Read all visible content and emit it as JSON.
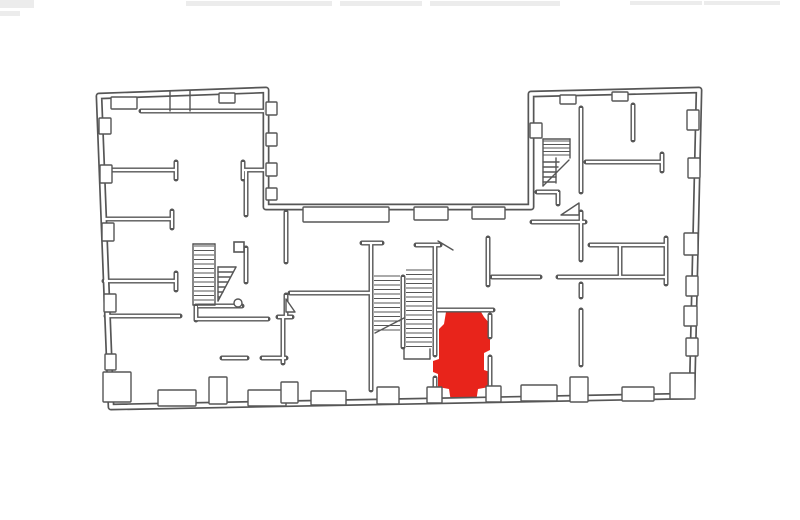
{
  "page": {
    "width": 800,
    "height": 520,
    "background": "#ffffff"
  },
  "plan": {
    "wall_color": "#565656",
    "paper_color": "#ffffff",
    "highlight_color": "#e8241b",
    "smudge_color": "#ececec",
    "top_smudges": [
      [
        0,
        0,
        34,
        8
      ],
      [
        186,
        1,
        146,
        5
      ],
      [
        340,
        1,
        82,
        5
      ],
      [
        430,
        1,
        130,
        5
      ],
      [
        630,
        1,
        72,
        4
      ],
      [
        704,
        1,
        76,
        4
      ],
      [
        0,
        11,
        20,
        5
      ]
    ],
    "outline": [
      [
        99,
        96
      ],
      [
        266,
        90
      ],
      [
        266,
        207
      ],
      [
        531,
        207
      ],
      [
        531,
        94
      ],
      [
        699,
        90
      ],
      [
        692,
        396
      ],
      [
        111,
        407
      ]
    ],
    "inner_walls": [
      [
        141,
        111,
        264,
        111
      ],
      [
        102,
        170,
        176,
        170
      ],
      [
        176,
        162,
        176,
        179
      ],
      [
        243,
        170,
        265,
        170
      ],
      [
        243,
        162,
        243,
        179
      ],
      [
        103,
        219,
        172,
        219
      ],
      [
        172,
        211,
        172,
        228
      ],
      [
        246,
        170,
        246,
        215
      ],
      [
        246,
        248,
        246,
        282
      ],
      [
        104,
        281,
        176,
        281
      ],
      [
        176,
        273,
        176,
        290
      ],
      [
        106,
        316,
        180,
        316
      ],
      [
        196,
        319,
        268,
        319
      ],
      [
        198,
        306,
        242,
        306
      ],
      [
        196,
        306,
        196,
        320
      ],
      [
        222,
        358,
        247,
        358
      ],
      [
        262,
        358,
        286,
        358
      ],
      [
        286,
        212,
        286,
        262
      ],
      [
        286,
        295,
        286,
        317
      ],
      [
        283,
        317,
        283,
        363
      ],
      [
        278,
        317,
        292,
        317
      ],
      [
        290,
        293,
        371,
        293
      ],
      [
        371,
        243,
        371,
        390
      ],
      [
        362,
        243,
        382,
        243
      ],
      [
        435,
        245,
        435,
        355
      ],
      [
        435,
        378,
        435,
        390
      ],
      [
        416,
        245,
        440,
        245
      ],
      [
        403,
        277,
        403,
        347
      ],
      [
        437,
        310,
        493,
        310
      ],
      [
        490,
        315,
        490,
        337
      ],
      [
        490,
        357,
        490,
        387
      ],
      [
        488,
        238,
        488,
        285
      ],
      [
        492,
        277,
        540,
        277
      ],
      [
        558,
        277,
        666,
        277
      ],
      [
        590,
        245,
        666,
        245
      ],
      [
        620,
        245,
        620,
        277
      ],
      [
        666,
        238,
        666,
        284
      ],
      [
        581,
        108,
        581,
        192
      ],
      [
        581,
        212,
        581,
        260
      ],
      [
        581,
        284,
        581,
        297
      ],
      [
        581,
        310,
        581,
        365
      ],
      [
        586,
        162,
        662,
        162
      ],
      [
        662,
        154,
        662,
        171
      ],
      [
        633,
        105,
        633,
        140
      ],
      [
        532,
        222,
        585,
        222
      ],
      [
        537,
        192,
        558,
        192
      ],
      [
        558,
        192,
        558,
        204
      ]
    ],
    "thin_lines": [
      [
        170,
        91,
        170,
        111
      ],
      [
        190,
        91,
        190,
        111
      ],
      [
        193,
        244,
        215,
        244
      ],
      [
        193,
        244,
        193,
        305
      ],
      [
        215,
        244,
        215,
        305
      ],
      [
        193,
        305,
        215,
        305
      ],
      [
        218,
        267,
        218,
        301
      ],
      [
        218,
        301,
        236,
        267
      ],
      [
        236,
        267,
        218,
        267
      ],
      [
        218,
        272,
        233,
        272
      ],
      [
        218,
        277,
        230,
        277
      ],
      [
        218,
        282,
        228,
        282
      ],
      [
        218,
        287,
        225,
        287
      ],
      [
        218,
        292,
        223,
        292
      ],
      [
        218,
        297,
        220,
        297
      ],
      [
        375,
        333,
        404,
        318
      ],
      [
        404,
        349,
        404,
        359
      ],
      [
        404,
        359,
        430,
        359
      ],
      [
        430,
        359,
        430,
        349
      ],
      [
        438,
        241,
        453,
        250
      ],
      [
        543,
        139,
        570,
        139
      ],
      [
        543,
        139,
        543,
        186
      ],
      [
        570,
        139,
        570,
        158
      ],
      [
        556,
        158,
        556,
        183
      ],
      [
        543,
        162,
        559,
        162
      ],
      [
        543,
        167,
        558,
        167
      ],
      [
        543,
        172,
        557,
        172
      ],
      [
        543,
        177,
        556,
        177
      ],
      [
        543,
        182,
        555,
        182
      ],
      [
        543,
        186,
        569,
        160
      ]
    ],
    "stairs": [
      {
        "x": 194,
        "y": 246,
        "w": 20,
        "h": 58,
        "step": 4.5
      },
      {
        "x": 374,
        "y": 276,
        "w": 26,
        "h": 56,
        "step": 4.5
      },
      {
        "x": 406,
        "y": 270,
        "w": 26,
        "h": 80,
        "step": 4.5
      },
      {
        "x": 543,
        "y": 141,
        "w": 27,
        "h": 17,
        "step": 3.5
      }
    ],
    "piers": [
      [
        99,
        118,
        12,
        16
      ],
      [
        100,
        165,
        12,
        18
      ],
      [
        102,
        223,
        12,
        18
      ],
      [
        104,
        294,
        12,
        18
      ],
      [
        105,
        354,
        11,
        16
      ],
      [
        111,
        97,
        26,
        12
      ],
      [
        219,
        93,
        16,
        10
      ],
      [
        266,
        102,
        11,
        13
      ],
      [
        266,
        133,
        11,
        13
      ],
      [
        266,
        163,
        11,
        13
      ],
      [
        266,
        188,
        11,
        12
      ],
      [
        303,
        207,
        86,
        15
      ],
      [
        414,
        207,
        34,
        13
      ],
      [
        472,
        207,
        33,
        12
      ],
      [
        530,
        123,
        12,
        15
      ],
      [
        560,
        95,
        16,
        9
      ],
      [
        612,
        92,
        16,
        9
      ],
      [
        687,
        110,
        12,
        20
      ],
      [
        688,
        158,
        12,
        20
      ],
      [
        684,
        233,
        14,
        22
      ],
      [
        686,
        276,
        12,
        20
      ],
      [
        684,
        306,
        13,
        20
      ],
      [
        686,
        338,
        12,
        18
      ],
      [
        103,
        372,
        28,
        30
      ],
      [
        158,
        390,
        38,
        16
      ],
      [
        209,
        377,
        18,
        27
      ],
      [
        248,
        390,
        38,
        16
      ],
      [
        281,
        382,
        17,
        21
      ],
      [
        311,
        391,
        35,
        14
      ],
      [
        377,
        387,
        22,
        17
      ],
      [
        427,
        387,
        15,
        16
      ],
      [
        486,
        386,
        15,
        16
      ],
      [
        521,
        385,
        36,
        16
      ],
      [
        570,
        377,
        18,
        25
      ],
      [
        622,
        387,
        32,
        14
      ],
      [
        670,
        373,
        25,
        26
      ]
    ],
    "door_swings": [
      [
        [
          286,
          299
        ],
        [
          295,
          312
        ],
        [
          286,
          312
        ]
      ],
      [
        [
          561,
          215
        ],
        [
          579,
          203
        ],
        [
          579,
          215
        ]
      ]
    ],
    "pillars": [
      [
        234,
        242,
        10,
        10
      ]
    ],
    "circles": [
      [
        238,
        303,
        4
      ]
    ],
    "highlight_room": {
      "points": [
        [
          446,
          312
        ],
        [
          481,
          312
        ],
        [
          484,
          317
        ],
        [
          490,
          324
        ],
        [
          490,
          350
        ],
        [
          484,
          353
        ],
        [
          484,
          370
        ],
        [
          490,
          372
        ],
        [
          489,
          387
        ],
        [
          478,
          389
        ],
        [
          476,
          402
        ],
        [
          451,
          402
        ],
        [
          449,
          389
        ],
        [
          438,
          387
        ],
        [
          438,
          374
        ],
        [
          433,
          372
        ],
        [
          433,
          361
        ],
        [
          439,
          359
        ],
        [
          439,
          329
        ],
        [
          444,
          324
        ]
      ]
    }
  }
}
